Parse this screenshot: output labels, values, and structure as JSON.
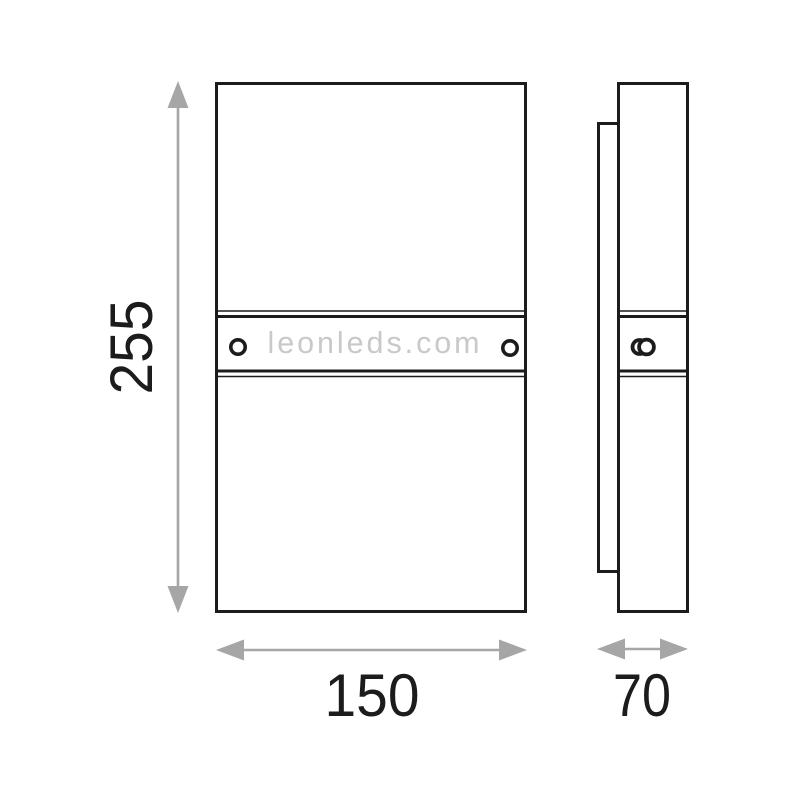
{
  "diagram": {
    "watermark": "leonleds.com",
    "dimensions": {
      "height": "255",
      "width": "150",
      "depth": "70"
    },
    "colors": {
      "line": "#1c1c1c",
      "dimension_arrow": "#a6a6a6",
      "watermark_text": "#c9c9c9",
      "background": "#ffffff"
    }
  }
}
